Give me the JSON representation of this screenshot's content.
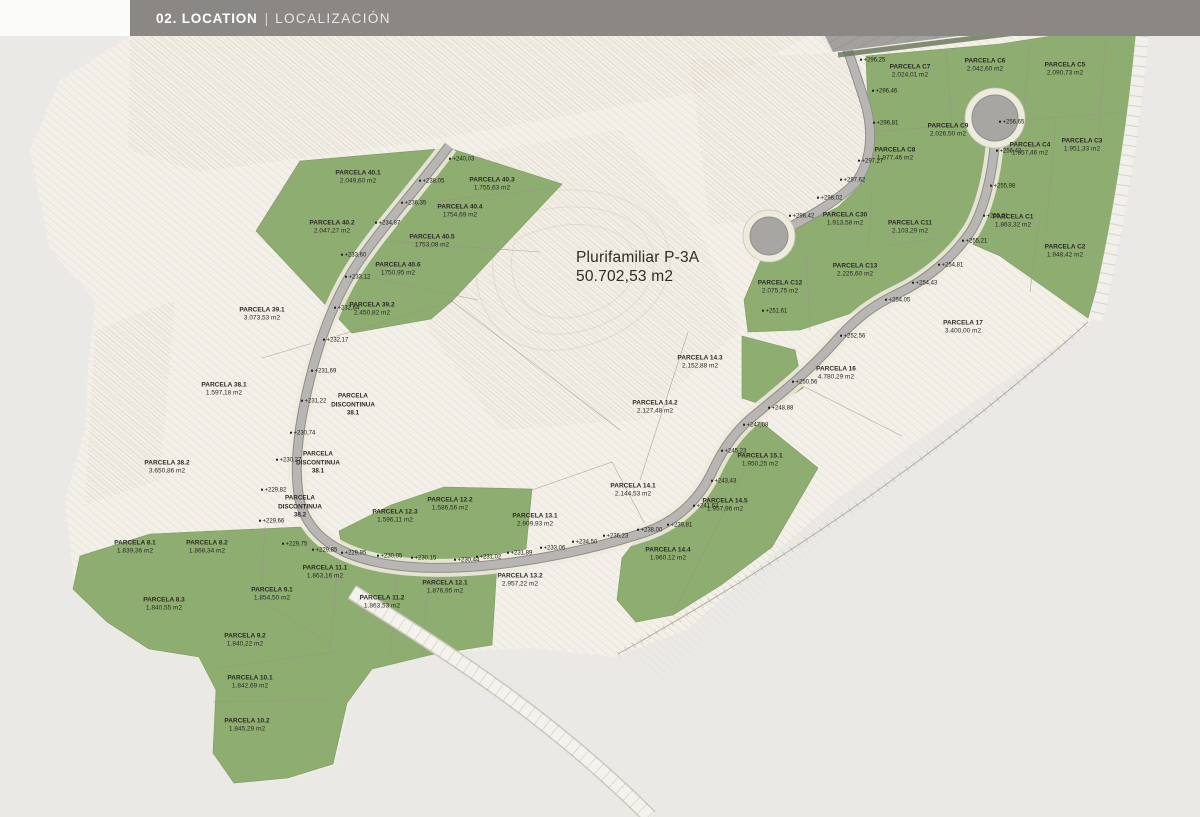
{
  "header": {
    "title": "02. LOCATION",
    "divider": "|",
    "subtitle": "LOCALIZACIÓN"
  },
  "map": {
    "road_label": "E - DO",
    "zone": {
      "name": "Plurifamiliar P-3A",
      "area": "50.702,53 m2",
      "x": 576,
      "y": 248
    },
    "colors": {
      "background": "#ebe9e6",
      "terrain": "#f3f0e9",
      "parcel_green": "#8ead70",
      "parcel_green_edge": "#7d9b5f",
      "road": "#b8b6b2",
      "road_edge": "#908e8a",
      "highway": "#a3a19d",
      "contour": "#d9cfc0",
      "header_bar": "#8a8784",
      "text": "#2c2b26"
    },
    "parcels": [
      {
        "name": "PARCELA 40.1",
        "area": "2.049,60 m2",
        "x": 358,
        "y": 178
      },
      {
        "name": "PARCELA 40.2",
        "area": "2.047,27 m2",
        "x": 332,
        "y": 228
      },
      {
        "name": "PARCELA 40.3",
        "area": "1.755,63 m2",
        "x": 492,
        "y": 185
      },
      {
        "name": "PARCELA 40.4",
        "area": "1754,69 m2",
        "x": 460,
        "y": 212
      },
      {
        "name": "PARCELA 40.5",
        "area": "1753,08 m2",
        "x": 432,
        "y": 242
      },
      {
        "name": "PARCELA 40.6",
        "area": "1750,95 m2",
        "x": 398,
        "y": 270
      },
      {
        "name": "PARCELA 39.1",
        "area": "3.073,53 m2",
        "x": 262,
        "y": 315
      },
      {
        "name": "PARCELA 39.2",
        "area": "2.450,82 m2",
        "x": 372,
        "y": 310
      },
      {
        "name": "PARCELA 38.1",
        "area": "1.597,18 m2",
        "x": 224,
        "y": 390
      },
      {
        "name": "PARCELA 38.2",
        "area": "3.650,86 m2",
        "x": 167,
        "y": 468
      },
      {
        "name": "PARCELA 8.1",
        "area": "1.839,36 m2",
        "x": 135,
        "y": 548
      },
      {
        "name": "PARCELA 8.2",
        "area": "1.868,34 m2",
        "x": 207,
        "y": 548
      },
      {
        "name": "PARCELA 8.3",
        "area": "1.840,55 m2",
        "x": 164,
        "y": 605
      },
      {
        "name": "PARCELA 9.1",
        "area": "1.854,50 m2",
        "x": 272,
        "y": 595
      },
      {
        "name": "PARCELA 9.2",
        "area": "1.840,22 m2",
        "x": 245,
        "y": 641
      },
      {
        "name": "PARCELA 10.1",
        "area": "1.842,69 m2",
        "x": 250,
        "y": 683
      },
      {
        "name": "PARCELA 10.2",
        "area": "1.845,29 m2",
        "x": 247,
        "y": 726
      },
      {
        "name": "PARCELA 11.1",
        "area": "1.863,16 m2",
        "x": 325,
        "y": 573
      },
      {
        "name": "PARCELA 11.2",
        "area": "1.863,53 m2",
        "x": 382,
        "y": 603
      },
      {
        "name": "PARCELA 12.1",
        "area": "1.876,95 m2",
        "x": 445,
        "y": 588
      },
      {
        "name": "PARCELA 12.2",
        "area": "1.586,56 m2",
        "x": 450,
        "y": 505
      },
      {
        "name": "PARCELA 12.3",
        "area": "1.596,11 m2",
        "x": 395,
        "y": 517
      },
      {
        "name": "PARCELA 13.1",
        "area": "2.909,93 m2",
        "x": 535,
        "y": 521
      },
      {
        "name": "PARCELA 13.2",
        "area": "2.957,22 m2",
        "x": 520,
        "y": 581
      },
      {
        "name": "PARCELA 14.1",
        "area": "2.144,53 m2",
        "x": 633,
        "y": 491
      },
      {
        "name": "PARCELA 14.2",
        "area": "2.127,48 m2",
        "x": 655,
        "y": 408
      },
      {
        "name": "PARCELA 14.3",
        "area": "2.152,88 m2",
        "x": 700,
        "y": 363
      },
      {
        "name": "PARCELA 14.4",
        "area": "1.960,12 m2",
        "x": 668,
        "y": 555
      },
      {
        "name": "PARCELA 14.5",
        "area": "1.957,96 m2",
        "x": 725,
        "y": 506
      },
      {
        "name": "PARCELA 15.1",
        "area": "1.950,25 m2",
        "x": 760,
        "y": 461
      },
      {
        "name": "PARCELA 16",
        "area": "4.780,29 m2",
        "x": 836,
        "y": 374
      },
      {
        "name": "PARCELA 17",
        "area": "3.400,00 m2",
        "x": 963,
        "y": 328
      },
      {
        "name": "PARCELA C7",
        "area": "2.024,01 m2",
        "x": 910,
        "y": 72
      },
      {
        "name": "PARCELA C6",
        "area": "2.042,60 m2",
        "x": 985,
        "y": 66
      },
      {
        "name": "PARCELA C5",
        "area": "2.090,73 m2",
        "x": 1065,
        "y": 70
      },
      {
        "name": "PARCELA C9",
        "area": "2.026,50 m2",
        "x": 948,
        "y": 131
      },
      {
        "name": "PARCELA C8",
        "area": "1.977,46 m2",
        "x": 895,
        "y": 155
      },
      {
        "name": "PARCELA C4",
        "area": "1.857,46 m2",
        "x": 1030,
        "y": 150
      },
      {
        "name": "PARCELA C3",
        "area": "1.951,33 m2",
        "x": 1082,
        "y": 146
      },
      {
        "name": "PARCELA C30",
        "area": "1.913,58 m2",
        "x": 845,
        "y": 220
      },
      {
        "name": "PARCELA C11",
        "area": "2.103,29 m2",
        "x": 910,
        "y": 228
      },
      {
        "name": "PARCELA C1",
        "area": "1.863,32 m2",
        "x": 1013,
        "y": 222
      },
      {
        "name": "PARCELA C2",
        "area": "1.948,42 m2",
        "x": 1065,
        "y": 252
      },
      {
        "name": "PARCELA C13",
        "area": "2.225,60 m2",
        "x": 855,
        "y": 271
      },
      {
        "name": "PARCELA C12",
        "area": "2.075,75 m2",
        "x": 780,
        "y": 288
      }
    ],
    "discontinuous": [
      {
        "lines": [
          "PARCELA",
          "DISCONTINUA",
          "38.1"
        ],
        "x": 353,
        "y": 405
      },
      {
        "lines": [
          "PARCELA",
          "DISCONTINUA",
          "38.1"
        ],
        "x": 318,
        "y": 463
      },
      {
        "lines": [
          "PARCELA",
          "DISCONTINUA",
          "38.2"
        ],
        "x": 300,
        "y": 507
      }
    ],
    "elevations": [
      {
        "v": "+240,03",
        "x": 450,
        "y": 160
      },
      {
        "v": "+238,05",
        "x": 420,
        "y": 182
      },
      {
        "v": "+236,35",
        "x": 402,
        "y": 204
      },
      {
        "v": "+234,87",
        "x": 376,
        "y": 224
      },
      {
        "v": "+233,60",
        "x": 342,
        "y": 256
      },
      {
        "v": "+233,12",
        "x": 346,
        "y": 278
      },
      {
        "v": "+232,64",
        "x": 335,
        "y": 309
      },
      {
        "v": "+232,17",
        "x": 324,
        "y": 341
      },
      {
        "v": "+231,69",
        "x": 312,
        "y": 372
      },
      {
        "v": "+231,22",
        "x": 302,
        "y": 402
      },
      {
        "v": "+230,74",
        "x": 291,
        "y": 434
      },
      {
        "v": "+230,27",
        "x": 277,
        "y": 461
      },
      {
        "v": "+229,82",
        "x": 262,
        "y": 491
      },
      {
        "v": "+229,66",
        "x": 260,
        "y": 522
      },
      {
        "v": "+229,75",
        "x": 283,
        "y": 545
      },
      {
        "v": "+229,85",
        "x": 313,
        "y": 551
      },
      {
        "v": "+229,95",
        "x": 342,
        "y": 554
      },
      {
        "v": "+230,05",
        "x": 378,
        "y": 557
      },
      {
        "v": "+230,15",
        "x": 412,
        "y": 559
      },
      {
        "v": "+230,44",
        "x": 455,
        "y": 561
      },
      {
        "v": "+231,02",
        "x": 477,
        "y": 558
      },
      {
        "v": "+231,89",
        "x": 508,
        "y": 554
      },
      {
        "v": "+233,06",
        "x": 541,
        "y": 549
      },
      {
        "v": "+234,50",
        "x": 573,
        "y": 543
      },
      {
        "v": "+236,23",
        "x": 604,
        "y": 537
      },
      {
        "v": "+238,00",
        "x": 638,
        "y": 531
      },
      {
        "v": "+239,81",
        "x": 668,
        "y": 526
      },
      {
        "v": "+241,63",
        "x": 694,
        "y": 507
      },
      {
        "v": "+243,43",
        "x": 712,
        "y": 482
      },
      {
        "v": "+245,23",
        "x": 722,
        "y": 452
      },
      {
        "v": "+247,08",
        "x": 744,
        "y": 426
      },
      {
        "v": "+248,88",
        "x": 769,
        "y": 409
      },
      {
        "v": "+250,56",
        "x": 793,
        "y": 383
      },
      {
        "v": "+251,61",
        "x": 763,
        "y": 312
      },
      {
        "v": "+252,56",
        "x": 841,
        "y": 337
      },
      {
        "v": "+254,05",
        "x": 886,
        "y": 301
      },
      {
        "v": "+254,43",
        "x": 913,
        "y": 284
      },
      {
        "v": "+254,81",
        "x": 939,
        "y": 266
      },
      {
        "v": "+255,21",
        "x": 963,
        "y": 242
      },
      {
        "v": "+255,61",
        "x": 984,
        "y": 217
      },
      {
        "v": "+255,98",
        "x": 991,
        "y": 187
      },
      {
        "v": "+256,42",
        "x": 997,
        "y": 152
      },
      {
        "v": "+256,65",
        "x": 1000,
        "y": 123
      },
      {
        "v": "+294,67",
        "x": 838,
        "y": 6
      },
      {
        "v": "+296,10",
        "x": 847,
        "y": 31
      },
      {
        "v": "+296,25",
        "x": 861,
        "y": 61
      },
      {
        "v": "+296,46",
        "x": 873,
        "y": 92
      },
      {
        "v": "+296,81",
        "x": 874,
        "y": 124
      },
      {
        "v": "+297,27",
        "x": 859,
        "y": 162
      },
      {
        "v": "+297,62",
        "x": 841,
        "y": 181
      },
      {
        "v": "+298,02",
        "x": 818,
        "y": 199
      },
      {
        "v": "+298,42",
        "x": 790,
        "y": 217
      }
    ]
  }
}
